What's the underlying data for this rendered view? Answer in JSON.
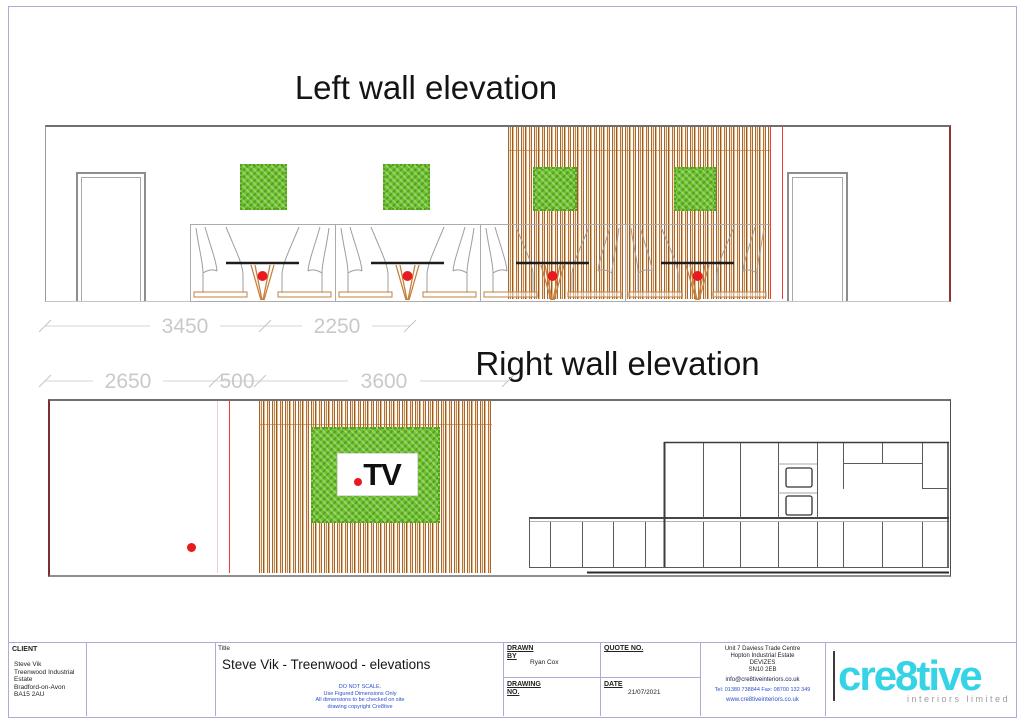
{
  "sheet": {
    "left_elevation": {
      "title": "Left wall elevation",
      "dimensions": [
        "3450",
        "2250"
      ]
    },
    "right_elevation": {
      "title": "Right wall elevation",
      "dimensions": [
        "2650",
        "500",
        "3600"
      ],
      "tv_logo_text": "TV"
    }
  },
  "title_block": {
    "client": {
      "label": "CLIENT",
      "lines": "Steve Vik\nTreenwood Industrial Estate\nBradford-on-Avon\nBA15 2AU"
    },
    "title": {
      "label": "Title",
      "value": "Steve Vik - Treenwood -  elevations",
      "disclaimer": "DO NOT SCALE.\nUse Figured Dimensions Only\nAll dimensions to be checked on site\ndrawing copyright Cre8tive"
    },
    "drawn_by": {
      "label": "DRAWN BY",
      "value": "Ryan Cox"
    },
    "drawing_no": {
      "label": "DRAWING NO.",
      "value": ""
    },
    "quote_no": {
      "label": "QUOTE NO.",
      "value": ""
    },
    "date": {
      "label": "DATE",
      "value": "21/07/2021"
    },
    "company": {
      "address": "Unit 7 Daviess Trade Centre\nHopton Industrial Estate\nDEVIZES\nSN10 2EB",
      "email": "info@cre8tiveinteriors.co.uk",
      "phone": "Tel: 01380 738844   Fax: 08700 132 349",
      "website": "www.cre8tiveinteriors.co.uk"
    },
    "logo": {
      "name": "cre8tive",
      "tagline": "interiors limited"
    }
  },
  "colors": {
    "accent_cyan": "#35d3e6",
    "moss_green": "#6ec32b",
    "marker_red": "#e8191f",
    "slat_brown": "#ad6827",
    "dim_gray": "#c9c9c9",
    "frame_purple": "#b3a8d8",
    "blueprint_blue": "#2b50c8"
  }
}
